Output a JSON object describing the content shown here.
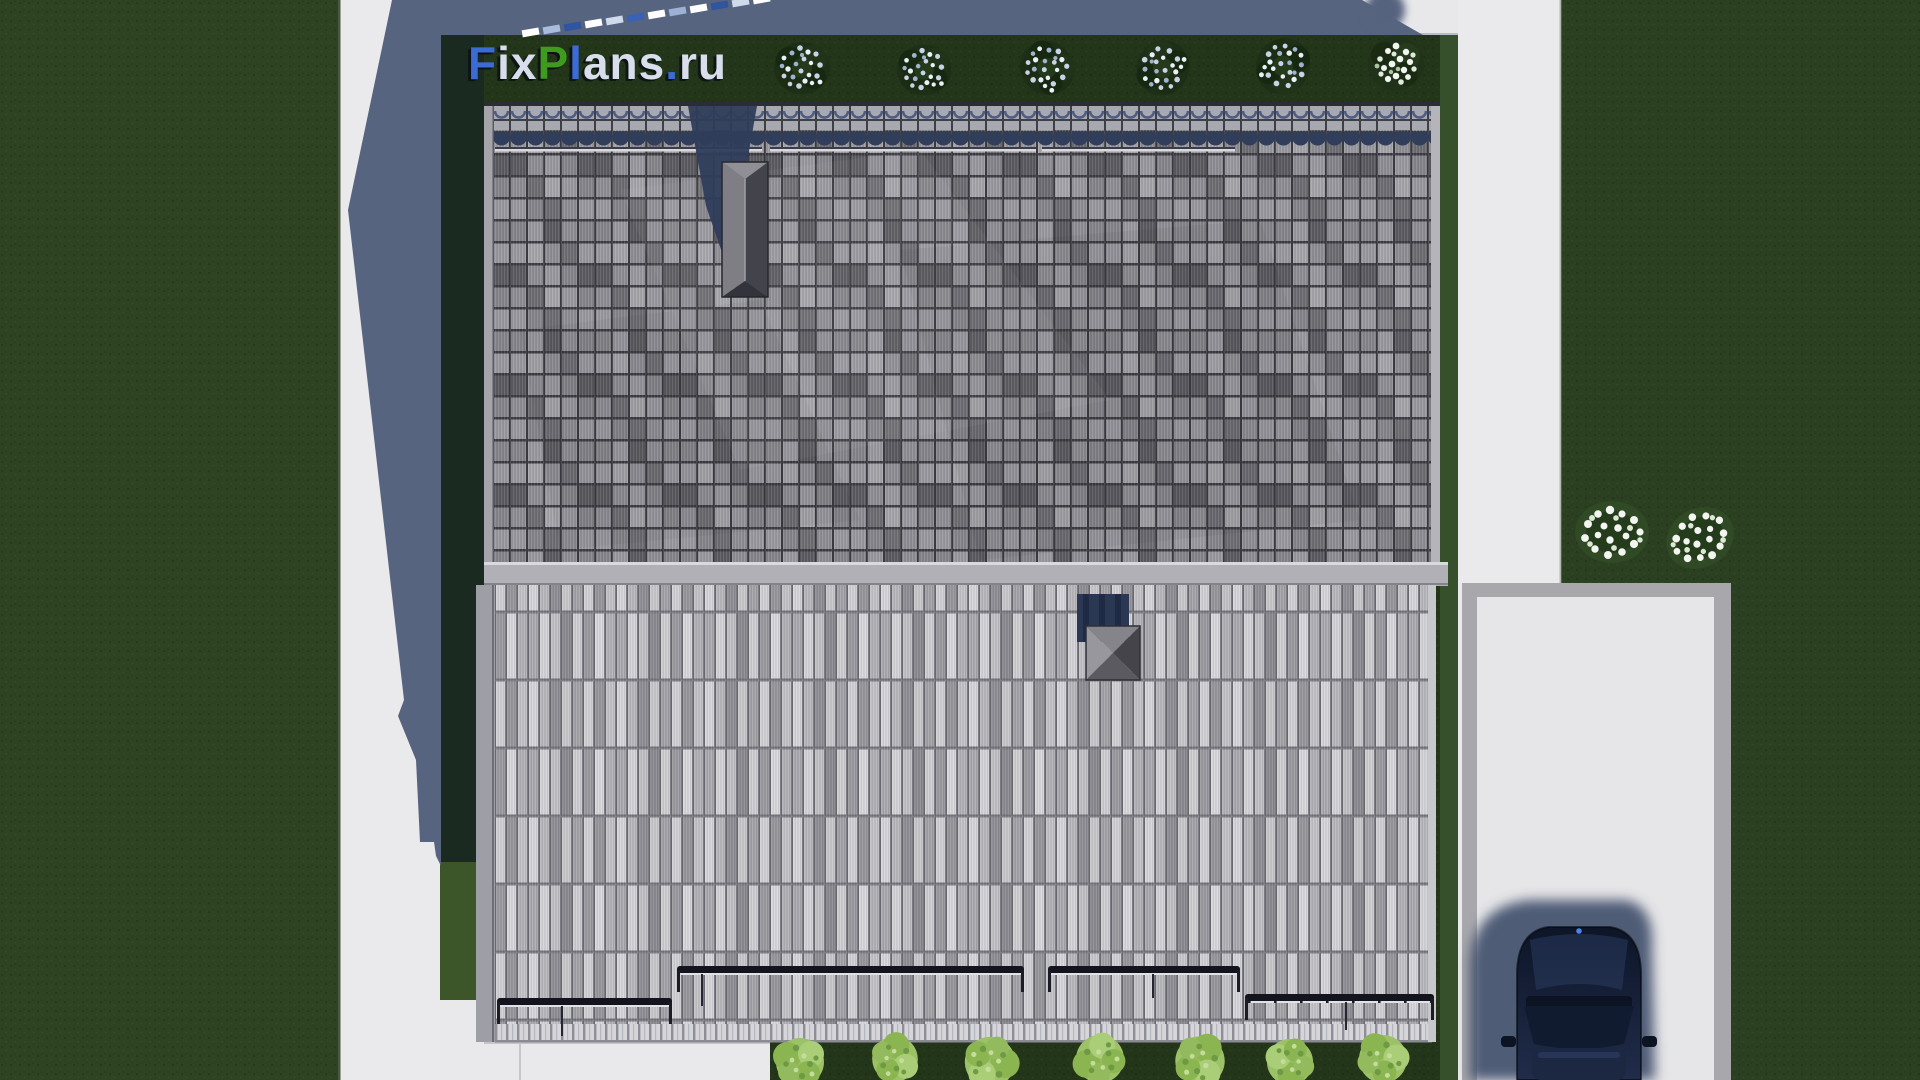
{
  "watermark": {
    "text": "FixPlans.ru",
    "segments": [
      {
        "text": "F",
        "color": "#3b6cd6"
      },
      {
        "text": "ix",
        "color": "#d8dfeb"
      },
      {
        "text": "P",
        "color": "#3f9b1f"
      },
      {
        "text": "l",
        "color": "#3b6cd6"
      },
      {
        "text": "ans",
        "color": "#d8dfeb"
      },
      {
        "text": ".",
        "color": "#3b6cd6"
      },
      {
        "text": "ru",
        "color": "#d8dfeb"
      }
    ]
  },
  "scene": {
    "type": "aerial-3d-architectural-render",
    "subject": "top-down roof plan of a house plot with lawns, walkways, driveway and parked car",
    "palette": {
      "pavement": "#e8e8ea",
      "shadow_blue": "#57647f",
      "grass_left": "#2e4322",
      "lawn_right": "#2b3f21",
      "plot_grass": "#233619",
      "roof_tiles_gray": "#86868c",
      "roof_sheet_gray": "#c0c0c4",
      "roof_gap": "#3c3c42",
      "snow_rail_dark": "#14141e",
      "chimney_gray": "#7e7e84",
      "vent_navy": "#2b3854",
      "tree_foliage_dark": "#1d2f16",
      "tree_bloom_blue": "#c8d3e6",
      "bush_foliage_light": "#9dc167",
      "flower_white": "#f2f5f0",
      "car_navy": "#141e36",
      "driveway_border": "#a8a8ac"
    },
    "counts": {
      "street_trees_top": 6,
      "hedge_bushes_bottom": 7,
      "flower_bushes_right": 2,
      "snow_guard_rails": 7,
      "chimneys": 1,
      "roof_vents": 1,
      "cars": 1
    }
  }
}
